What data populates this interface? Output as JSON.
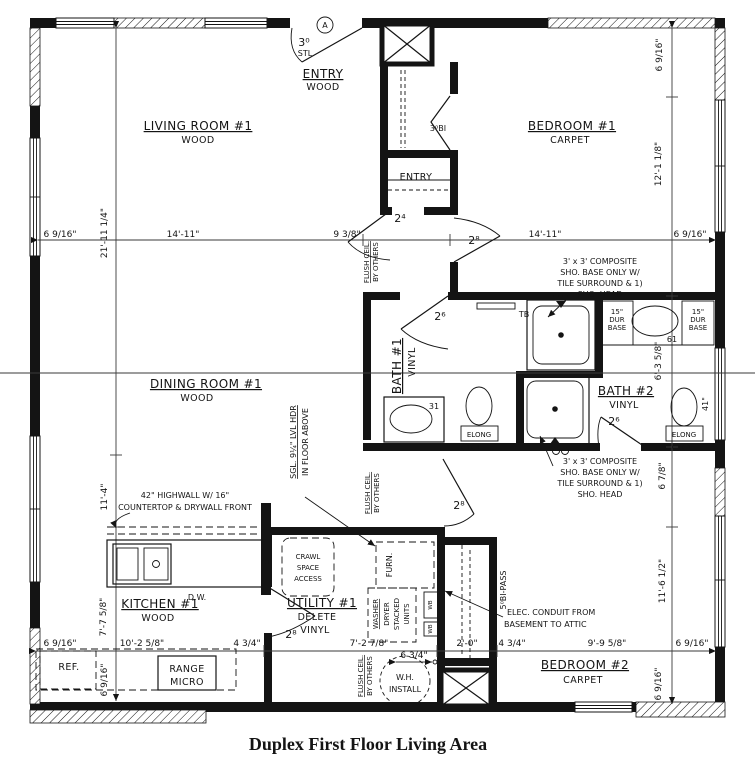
{
  "title": "Duplex First Floor Living Area",
  "rooms": {
    "living": {
      "name": "LIVING ROOM #1",
      "floor": "WOOD"
    },
    "dining": {
      "name": "DINING ROOM #1",
      "floor": "WOOD"
    },
    "kitchen": {
      "name": "KITCHEN #1",
      "floor": "WOOD"
    },
    "utility": {
      "name": "UTILITY #1",
      "floor1": "DELETE",
      "floor2": "VINYL"
    },
    "bedroom1": {
      "name": "BEDROOM #1",
      "floor": "CARPET"
    },
    "bedroom2": {
      "name": "BEDROOM #2",
      "floor": "CARPET"
    },
    "bath1": {
      "name": "BATH #1",
      "floor": "VINYL"
    },
    "bath2": {
      "name": "BATH #2",
      "floor": "VINYL"
    },
    "entry": {
      "name": "ENTRY",
      "floor": "WOOD"
    },
    "entry_closet": {
      "name": "ENTRY"
    }
  },
  "doors": {
    "front_size": "3⁰",
    "front_material": "STL",
    "front_marker": "A",
    "entry_closet": "2⁴",
    "bedroom1": "2⁸",
    "bath1": "2⁶",
    "bath2": "2⁶",
    "hall_bedroom2": "2⁸",
    "utility": "2⁸",
    "bedroom1_closet": "3⁰BI",
    "bedroom2_closet": "5⁰BI-PASS"
  },
  "dimensions": {
    "top": [
      "6 9/16\"",
      "14'-11\"",
      "9 3/8\"",
      "14'-11\"",
      "6 9/16\""
    ],
    "bottom": [
      "6 9/16\"",
      "10'-2 5/8\"",
      "4 3/4\"",
      "7'-2 7/8\"",
      "6 3/4\"",
      "2'-0\"",
      "4 3/4\"",
      "9'-9 5/8\"",
      "6 9/16\""
    ],
    "left": [
      "21'-11 1/4\"",
      "11'-4\"",
      "7'-7 5/8\"",
      "6 9/16\""
    ],
    "right": [
      "6 9/16\"",
      "12'-1 1/8\"",
      "6'-3 5/8\"",
      "6 7/8\"",
      "11'-6 1/2\"",
      "6 9/16\""
    ],
    "bath1_vanity": "31",
    "bath2_vanity": "61",
    "bath2_toilet": "41\""
  },
  "annotations": {
    "flush_ceiling": [
      "FLUSH CEIL.",
      "BY OTHERS"
    ],
    "lvl_header": [
      "SGL. 9¼\" LVL HDR",
      "IN FLOOR ABOVE"
    ],
    "composite_shower": [
      "3' x 3' COMPOSITE",
      "SHO. BASE ONLY W/",
      "TILE SURROUND & 1)",
      "SHO. HEAD"
    ],
    "highwall": [
      "42\" HIGHWALL W/ 16\"",
      "COUNTERTOP & DRYWALL FRONT"
    ],
    "elec_conduit": [
      "ELEC. CONDUIT FROM",
      "BASEMENT TO ATTIC"
    ],
    "crawl_access": [
      "CRAWL",
      "SPACE",
      "ACCESS"
    ],
    "wh_install": [
      "W.H.",
      "INSTALL"
    ],
    "washer_dryer": [
      "WASHER",
      "DRYER",
      "STACKED",
      "UNITS"
    ]
  },
  "fixtures": {
    "towel_bar": "TB",
    "toilet": "ELONG",
    "vanity_base": [
      "15\"",
      "DUR",
      "BASE"
    ],
    "dishwasher": "D.W.",
    "refrigerator": "REF.",
    "range": "RANGE",
    "microwave": "MICRO",
    "furnace": "FURN.",
    "washer_box": "WB"
  }
}
